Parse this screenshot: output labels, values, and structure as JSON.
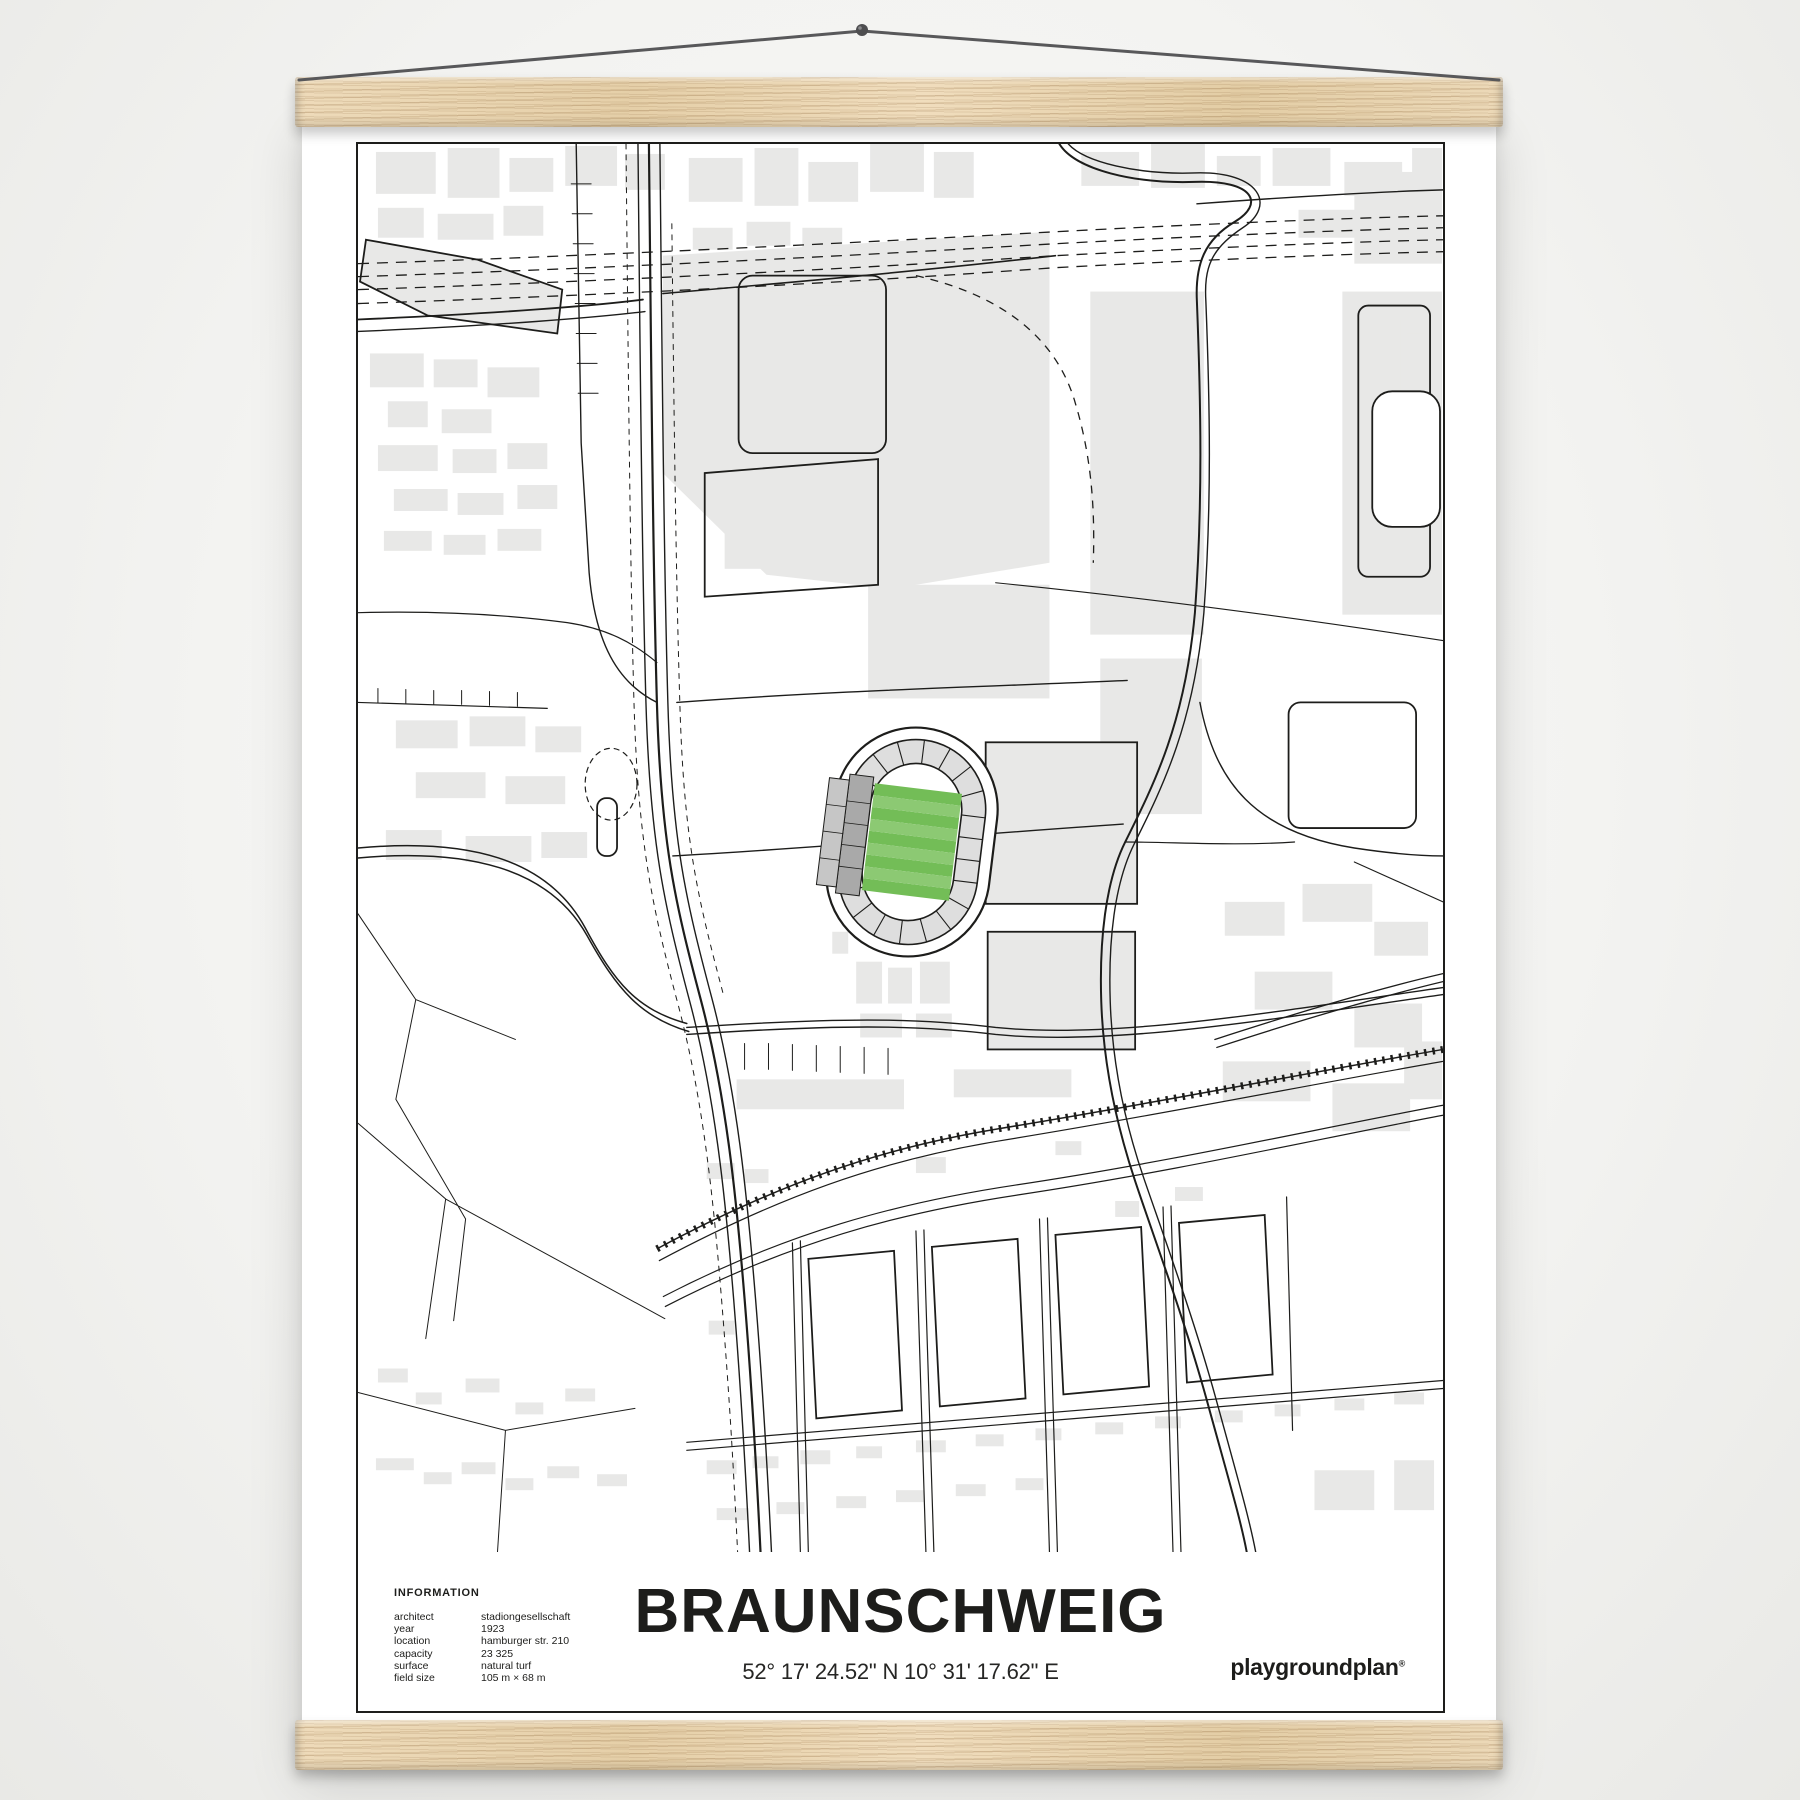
{
  "poster": {
    "title": "BRAUNSCHWEIG",
    "coordinates": "52° 17' 24.52\" N  10° 31' 17.62\" E",
    "information": {
      "heading": "INFORMATION",
      "rows": [
        {
          "label": "architect",
          "value": "stadiongesellschaft"
        },
        {
          "label": "year",
          "value": "1923"
        },
        {
          "label": "location",
          "value": "hamburger str. 210"
        },
        {
          "label": "capacity",
          "value": "23 325"
        },
        {
          "label": "surface",
          "value": "natural turf"
        },
        {
          "label": "field size",
          "value": "105 m × 68 m"
        }
      ]
    },
    "brand": {
      "logo_text": "playgroundplan",
      "registered_mark": "®"
    }
  },
  "map": {
    "colors": {
      "line": "#1d1d1b",
      "building": "#e8e8e7",
      "stand_light": "#dedede",
      "stand_mid": "#c6c6c6",
      "stand_dark": "#a9a9a9",
      "pitch_dark": "#73bd57",
      "pitch_light": "#8cc973"
    }
  },
  "frame_hardware": {
    "wood_color": "#e9d6b4",
    "string_color": "#58585a"
  }
}
